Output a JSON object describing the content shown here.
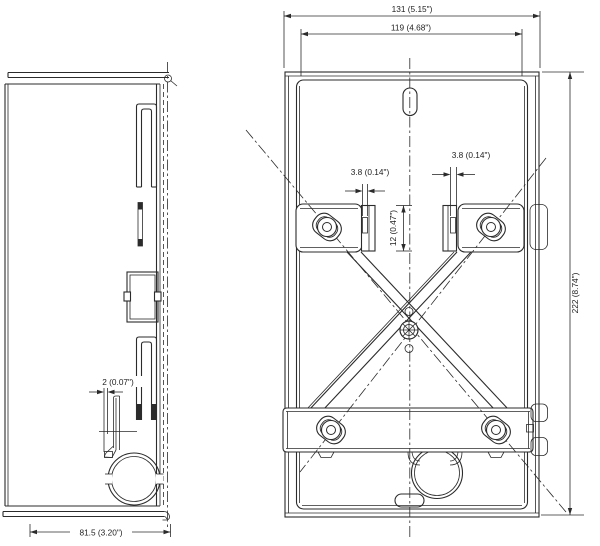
{
  "drawing": {
    "type": "technical-dimension-drawing",
    "subject": "wall-mount enclosure / backplate, side view and front view",
    "background_color": "#ffffff",
    "line_color": "#2b2b2b",
    "views": {
      "side": {
        "name": "side-view"
      },
      "front": {
        "name": "front-view"
      }
    },
    "dimensions": {
      "front_overall_width": "131 (5.15\")",
      "front_inner_width": "119 (4.68\")",
      "strap_slot_left": "3.8 (0.14\")",
      "strap_slot_right": "3.8 (0.14\")",
      "bracket_slot_height": "12 (0.47\")",
      "overall_height": "222 (8.74\")",
      "side_depth": "81.5 (3.20\")",
      "clip_gap": "2 (0.07\")"
    }
  }
}
